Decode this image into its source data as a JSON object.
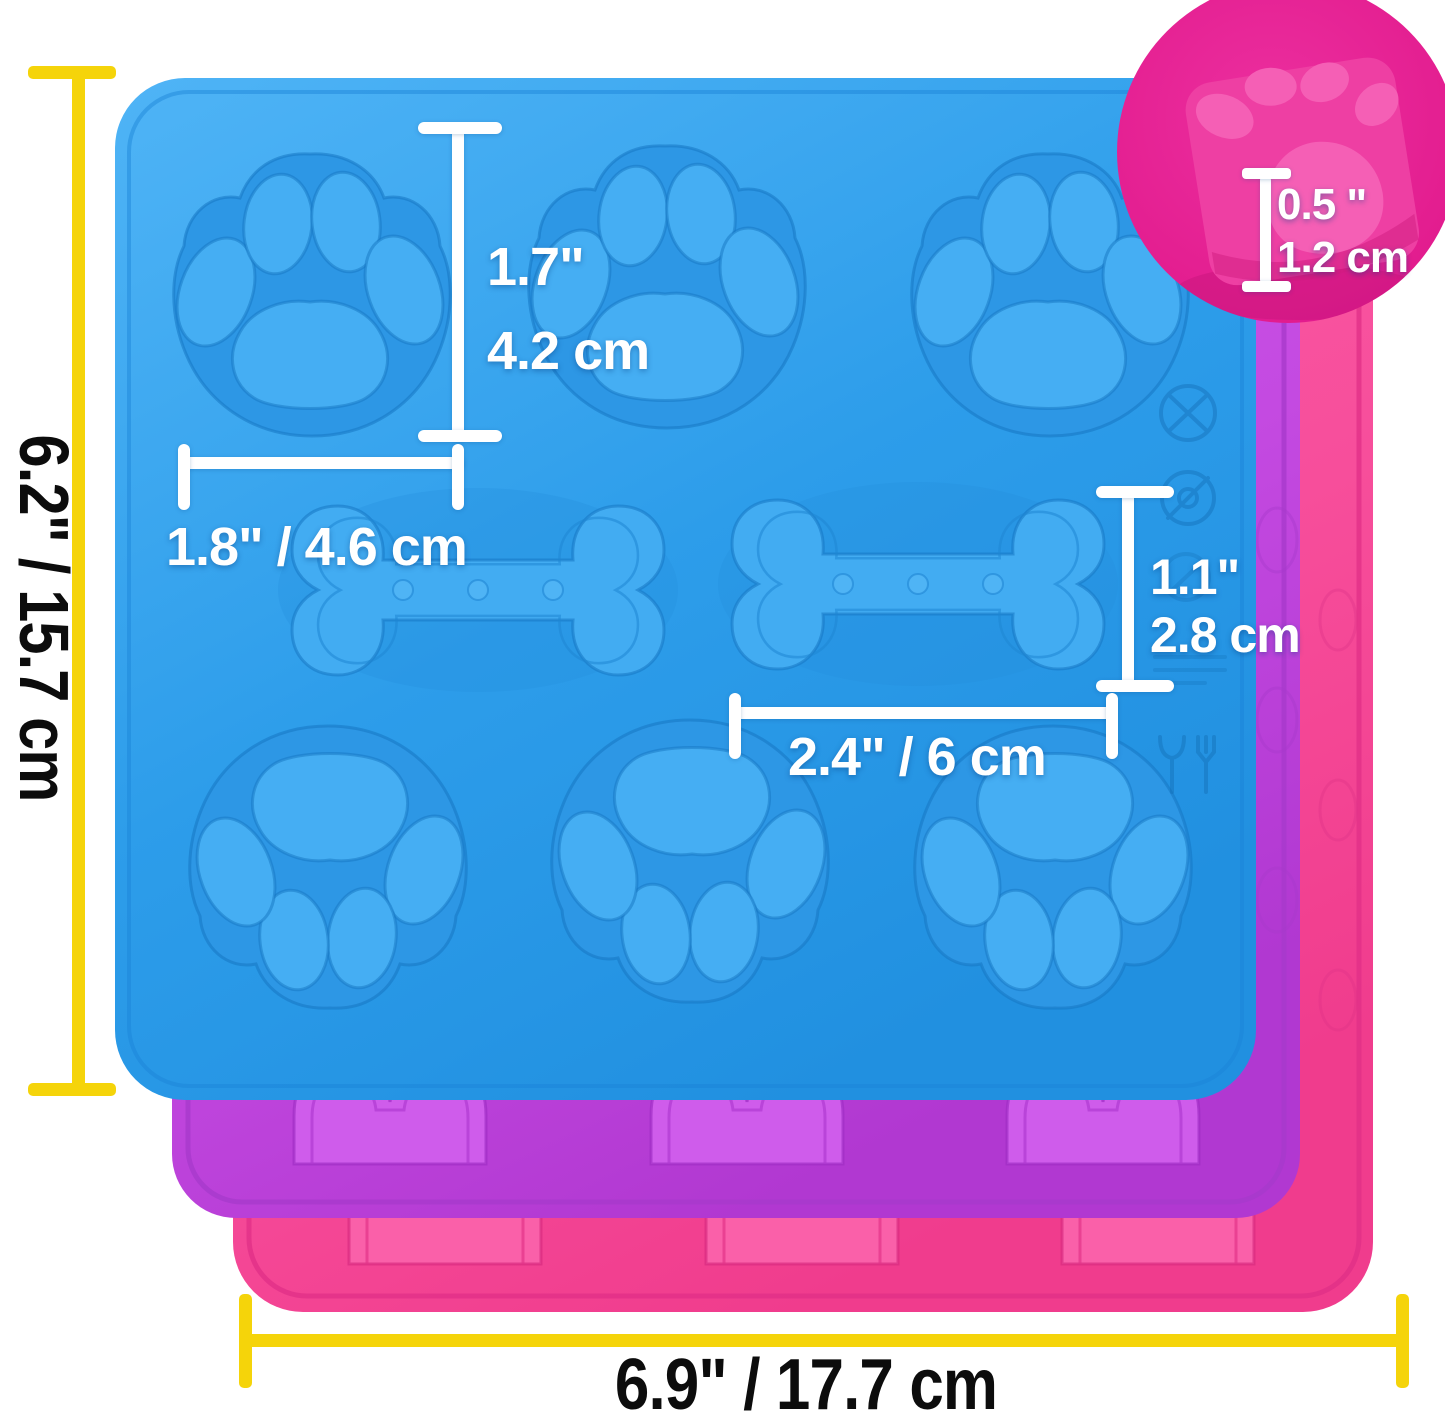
{
  "canvas": {
    "width": 1445,
    "height": 1421,
    "background": "#ffffff"
  },
  "product": {
    "name": "silicone dog treat molds",
    "description": "Three stacked silicone molds (blue front, purple middle, pink back) with six paw-print cavities and two bone cavities; round inset shows mold depth",
    "mold_colors": {
      "front_blue": "#2E9FEB",
      "middle_purple": "#C74FE4",
      "back_pink": "#F7519C",
      "inset_circle_pink": "#E6249A"
    },
    "cavities": {
      "paw_count": 6,
      "bone_count": 2,
      "dots_per_bone": 3
    }
  },
  "annotations": {
    "line_colors": {
      "outer_lines": "#F5D40A",
      "inner_lines": "#FFFFFF"
    },
    "text_colors": {
      "outer_labels": "#0C0C0C",
      "inner_labels": "#FFFFFF"
    },
    "overall_height": {
      "label": "6.2\" / 15.7 cm"
    },
    "overall_width": {
      "label": "6.9\" / 17.7 cm"
    },
    "paw_height": {
      "inches": "1.7\"",
      "cm": "4.2 cm"
    },
    "paw_width": {
      "label": "1.8\" / 4.6 cm"
    },
    "bone_height": {
      "inches": "1.1\"",
      "cm": "2.8 cm"
    },
    "bone_width": {
      "label": "2.4\" / 6 cm"
    },
    "mold_depth": {
      "inches": "0.5 \"",
      "cm": "1.2 cm"
    }
  },
  "embossed_icons": [
    {
      "name": "crossed-out-circle-icon"
    },
    {
      "name": "no-symbol-circle-icon"
    },
    {
      "name": "faint-crossed-circle-icon"
    },
    {
      "name": "embossed-text-marks"
    },
    {
      "name": "glass-and-fork-food-safe-icon"
    }
  ]
}
